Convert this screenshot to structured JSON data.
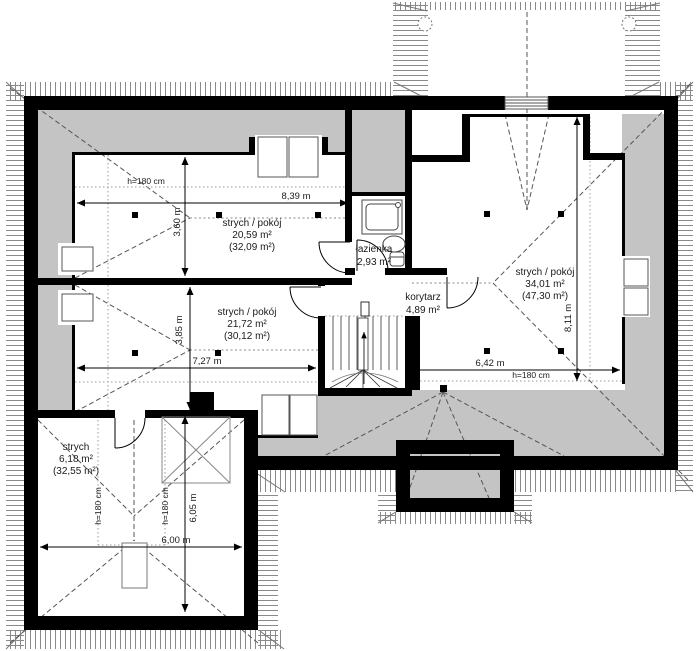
{
  "title": "attic floor plan",
  "colors": {
    "wall": "#000000",
    "low_zone": "#c4c4c4",
    "hatch": "#8a8a8a",
    "dash": "#555555",
    "paper": "#ffffff"
  },
  "rooms": {
    "room1": {
      "name": "strych / pokój",
      "area": "20,59 m²",
      "floor_area": "(32,09 m²)"
    },
    "room2": {
      "name": "strych / pokój",
      "area": "21,72 m²",
      "floor_area": "(30,12 m²)"
    },
    "room3": {
      "name": "strych / pokój",
      "area": "34,01 m²",
      "floor_area": "(47,30 m²)"
    },
    "bathroom": {
      "name": "łazienka",
      "area": "2,93 m²"
    },
    "corridor": {
      "name": "korytarz",
      "area": "4,89 m²"
    },
    "attic": {
      "name": "strych",
      "area": "6,18 m²",
      "floor_area": "(32,55 m²)"
    }
  },
  "dimensions": {
    "room1_width": "8,39 m",
    "room1_depth": "3,60 m",
    "room1_headroom": "h=180 cm",
    "room2_width": "7,27 m",
    "room2_depth": "3,85 m",
    "room3_width": "6,42 m",
    "room3_depth": "8,11 m",
    "room3_headroom": "h=180 cm",
    "attic_width": "6,00 m",
    "attic_depth": "6,05 m",
    "attic_headroom_left": "h=180 cm",
    "attic_headroom_right": "h=180 cm"
  }
}
